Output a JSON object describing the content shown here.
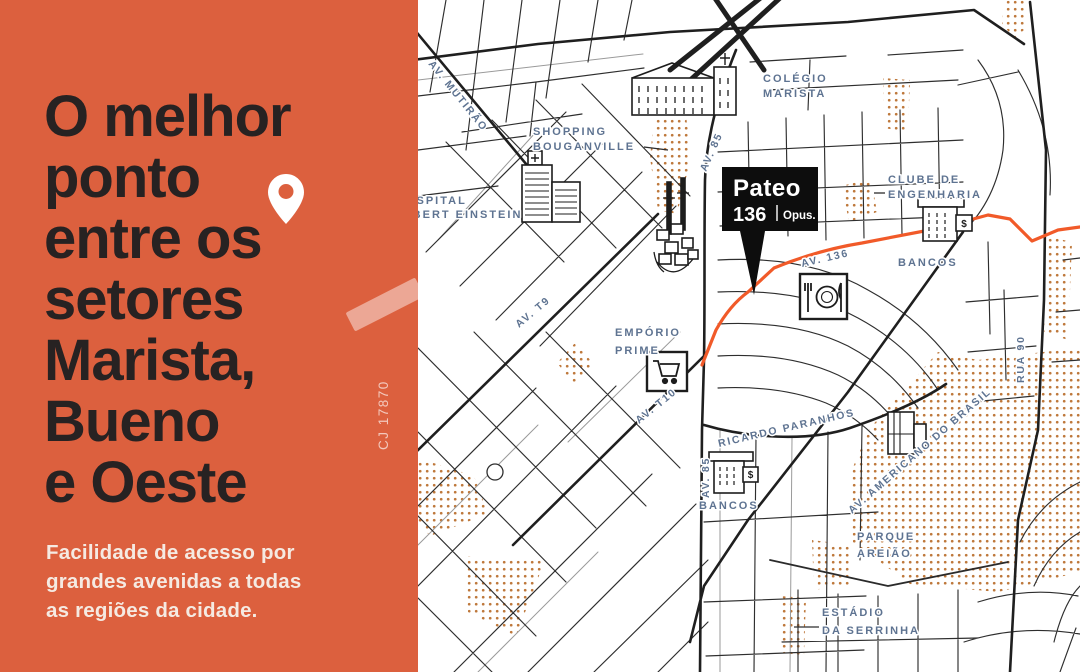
{
  "panel": {
    "title_lines": [
      "O melhor",
      "ponto",
      "entre os",
      "setores",
      "Marista,",
      "Bueno",
      "e Oeste"
    ],
    "subtitle_lines": [
      "Facilidade de acesso por",
      "grandes avenidas a todas",
      "as regiões da cidade."
    ],
    "watermark": "CJ 17870",
    "colors": {
      "background": "#DC603E",
      "title": "#272222",
      "subtitle": "#F5EAE2",
      "pin": "#FFFFFF"
    }
  },
  "map": {
    "marker": {
      "name": "Pateo",
      "number": "136",
      "brand": "Opus."
    },
    "labels": {
      "av_mutirao": "AV. MUTIRÃO",
      "av_85_top": "AV. 85",
      "av_85_bottom": "AV. 85",
      "av_t9": "AV. T9",
      "av_t10": "AV. T10",
      "av_136": "AV. 136",
      "rua_90": "RUA 90",
      "ricardo_paranhos": "RICARDO PARANHOS",
      "av_americano": "AV. AMERICANO DO BRASIL",
      "shopping_line1": "SHOPPING",
      "shopping_line2": "BOUGANVILLE",
      "colegio_line1": "COLÉGIO",
      "colegio_line2": "MARISTA",
      "hospital_line1": "HOSPITAL",
      "hospital_line2": "ALBERT EINSTEIN",
      "clube_line1": "CLUBE DE",
      "clube_line2": "ENGENHARIA",
      "bancos_top": "BANCOS",
      "bancos_bottom": "BANCOS",
      "emporio_line1": "EMPÓRIO",
      "emporio_line2": "PRIME",
      "parque_line1": "PARQUE",
      "parque_line2": "AREIÃO",
      "estadio_line1": "ESTÁDIO",
      "estadio_line2": "DA SERRINHA",
      "bank_sign": "$"
    },
    "colors": {
      "highlight_road": "#F15A29",
      "road": "#2B2B2B",
      "map_label": "#5E7391",
      "stipple": "#BE783B",
      "marker_background": "#0D0D0D",
      "marker_text": "#FFFFFF"
    }
  }
}
